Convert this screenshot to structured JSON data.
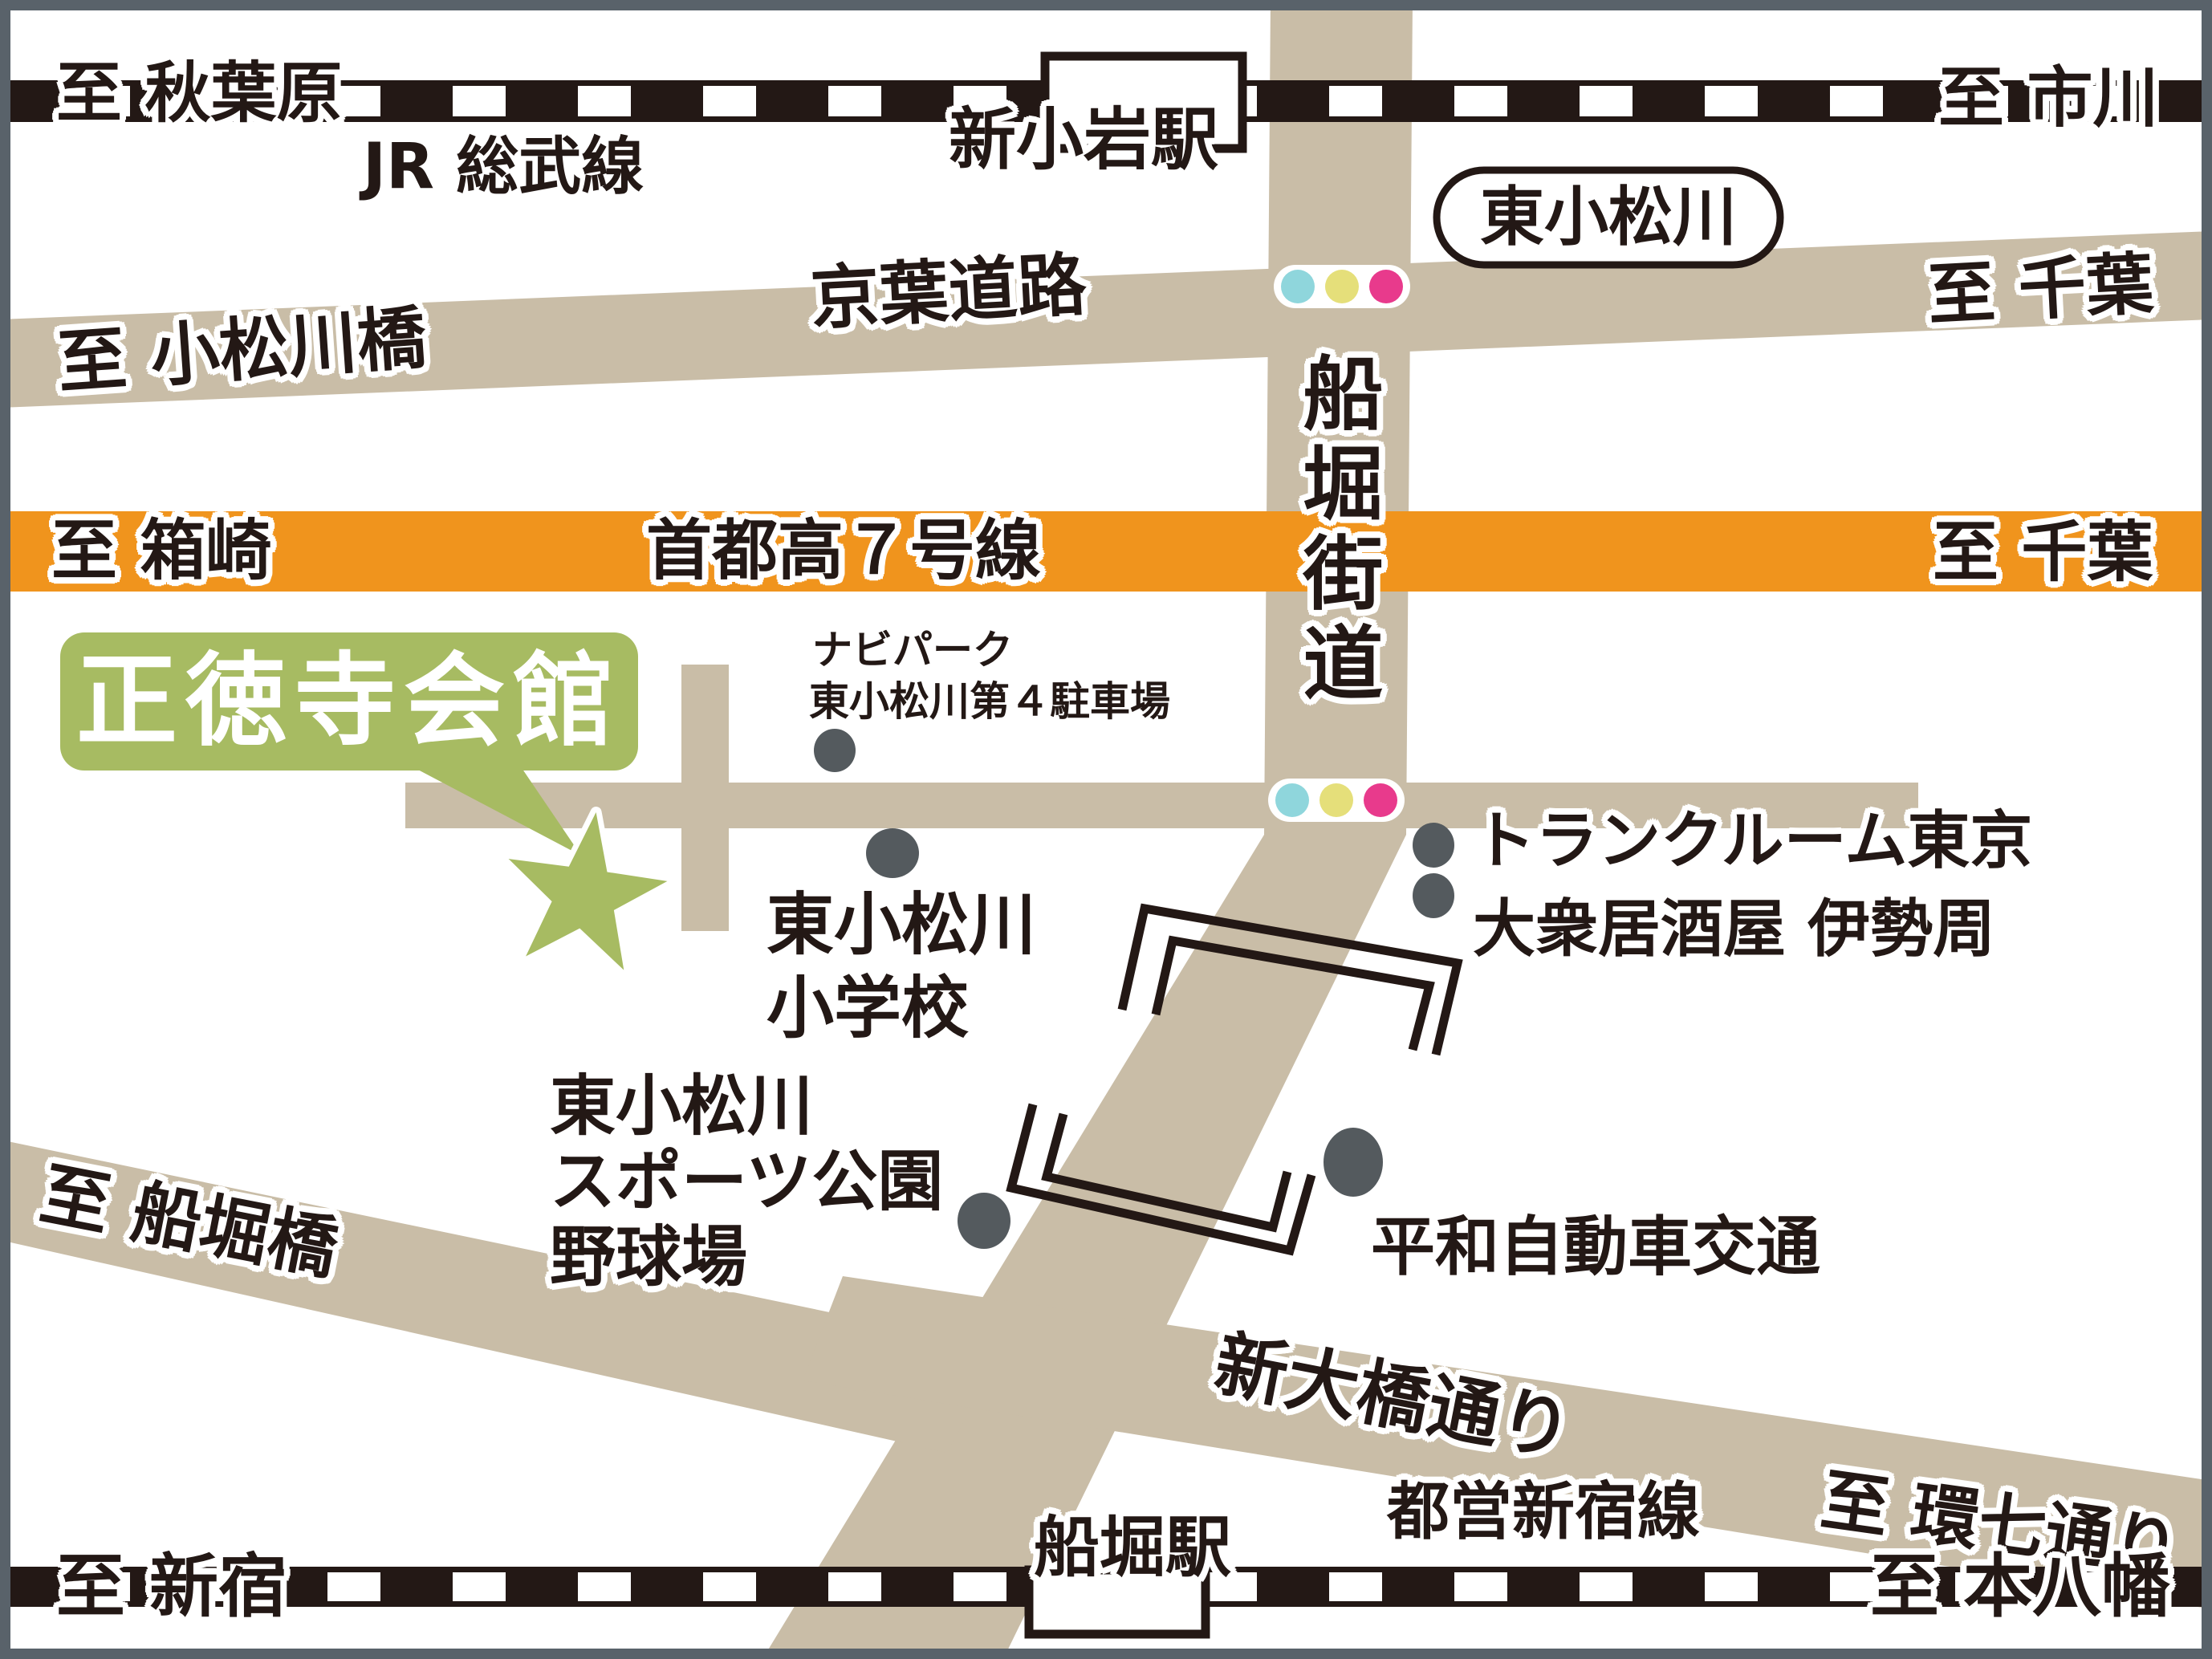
{
  "map_title": "正徳寺会館 アクセスマップ",
  "colors": {
    "road": "#c9bda7",
    "highway_orange": "#f0941d",
    "ink": "#231815",
    "venue_green": "#a7bb62",
    "marker_dot": "#545a5e",
    "signal_cyan": "#8fd6dc",
    "signal_yellow": "#e5df7a",
    "signal_pink": "#e83a8c",
    "frame_gray": "#59626a"
  },
  "railways": {
    "jr": {
      "name": "JR 総武線",
      "left": "至 秋葉原",
      "right": "至 市川",
      "station": "新小岩駅"
    },
    "toei": {
      "name": "都営新宿線",
      "left": "至 新宿",
      "right": "至 本八幡",
      "station": "船堀駅"
    }
  },
  "roads": {
    "keiyo": {
      "name": "京葉道路",
      "left": "至 小松川橋",
      "right": "至 千葉"
    },
    "shutoko": {
      "name": "首都高７号線",
      "left": "至 箱崎",
      "right": "至 千葉"
    },
    "funabori_kaido": {
      "name": "船堀街道"
    },
    "shin_ohashi": {
      "name": "新大橋通り",
      "right": "至 環七通り"
    },
    "funaboribashi": {
      "left": "至 船堀橋"
    }
  },
  "landmarks": {
    "venue": {
      "name": "正徳寺会館"
    },
    "bus_stop": {
      "name": "東小松川"
    },
    "parking": {
      "line1": "ナビパーク",
      "line2": "東小松川第４駐車場"
    },
    "school": {
      "line1": "東小松川",
      "line2": "小学校"
    },
    "trunk_room": {
      "name": "トランクルーム東京"
    },
    "izakaya": {
      "name": "大衆居酒屋 伊勢周"
    },
    "sports_park": {
      "line1": "東小松川",
      "line2": "スポーツ公園",
      "line3": "野球場"
    },
    "taxi": {
      "name": "平和自動車交通"
    }
  }
}
